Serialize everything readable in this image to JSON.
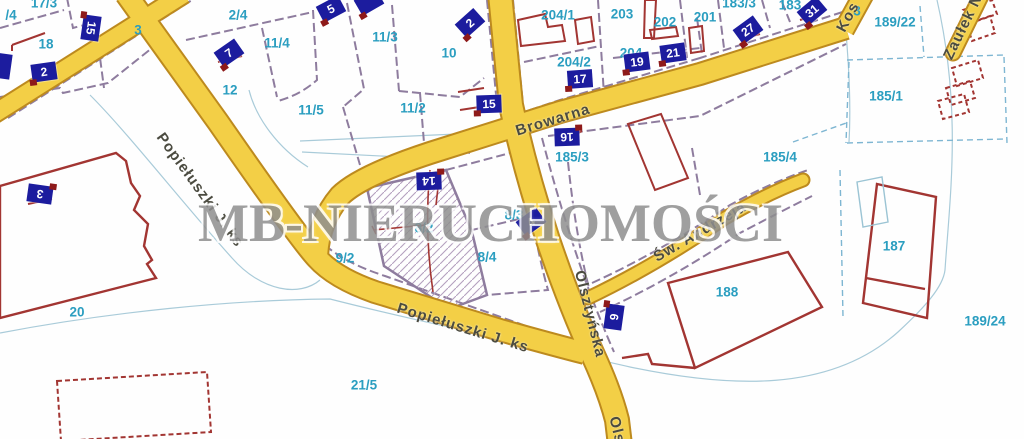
{
  "map": {
    "kind": "cadastral-map",
    "watermark": "MB-NIERUCHOMOŚCI",
    "highlighted_parcel": {
      "parcel": "8/2",
      "style": "diagonal-hatch"
    }
  },
  "colors": {
    "road_fill": "#F3CF46",
    "road_casing": "#BD8A1E",
    "parcel_line": "#8E7C9E",
    "building_line": "#A23532",
    "contour_line": "#A9CBD9",
    "parcel_dashed_blue": "#7EB6D2",
    "parcel_number_text": "#2B9EC0",
    "badge_background": "#1C1C9E",
    "badge_text": "#FFFFFF",
    "badge_notch": "#8E1A1A",
    "street_text": "#4B4B40",
    "watermark_text": "#8F8F8F"
  },
  "streets": [
    {
      "name": "Browarna",
      "x": 553,
      "y": 120,
      "rot": -17
    },
    {
      "name": "Popiełuszki J. ks",
      "x": 200,
      "y": 190,
      "rot": 54
    },
    {
      "name": "Popiełuszki J. ks",
      "x": 463,
      "y": 328,
      "rot": 17
    },
    {
      "name": "Olsztyńska",
      "x": 590,
      "y": 314,
      "rot": 76
    },
    {
      "name": "Olsz",
      "x": 618,
      "y": 434,
      "rot": 76
    },
    {
      "name": "Św. Andrzeja",
      "x": 700,
      "y": 232,
      "rot": -30
    },
    {
      "name": "Kos",
      "x": 848,
      "y": 17,
      "rot": -62
    },
    {
      "name": "Zaułek N",
      "x": 963,
      "y": 27,
      "rot": -64
    }
  ],
  "parcel_labels": [
    {
      "text": "17/3",
      "x": 44,
      "y": 3
    },
    {
      "text": "/4",
      "x": 11,
      "y": 15
    },
    {
      "text": "18",
      "x": 46,
      "y": 44
    },
    {
      "text": "2/4",
      "x": 238,
      "y": 15
    },
    {
      "text": "3",
      "x": 138,
      "y": 30
    },
    {
      "text": "11/4",
      "x": 277,
      "y": 43
    },
    {
      "text": "11/3",
      "x": 385,
      "y": 37
    },
    {
      "text": "10",
      "x": 449,
      "y": 53
    },
    {
      "text": "12",
      "x": 230,
      "y": 90
    },
    {
      "text": "11/5",
      "x": 311,
      "y": 110
    },
    {
      "text": "11/2",
      "x": 413,
      "y": 108
    },
    {
      "text": "204/1",
      "x": 558,
      "y": 15
    },
    {
      "text": "203",
      "x": 622,
      "y": 14
    },
    {
      "text": "202",
      "x": 665,
      "y": 22
    },
    {
      "text": "201",
      "x": 705,
      "y": 17
    },
    {
      "text": "183/3",
      "x": 739,
      "y": 3
    },
    {
      "text": "183",
      "x": 790,
      "y": 5
    },
    {
      "text": "204/2",
      "x": 574,
      "y": 62
    },
    {
      "text": "204",
      "x": 631,
      "y": 53
    },
    {
      "text": "189/22",
      "x": 895,
      "y": 22
    },
    {
      "text": "3",
      "x": 857,
      "y": 11
    },
    {
      "text": "185/1",
      "x": 886,
      "y": 96
    },
    {
      "text": "185/3",
      "x": 572,
      "y": 157
    },
    {
      "text": "185/4",
      "x": 780,
      "y": 157
    },
    {
      "text": "9/2",
      "x": 345,
      "y": 258
    },
    {
      "text": "8/2",
      "x": 424,
      "y": 228
    },
    {
      "text": "8/4",
      "x": 487,
      "y": 257
    },
    {
      "text": "8/3",
      "x": 514,
      "y": 215
    },
    {
      "text": "187",
      "x": 894,
      "y": 246
    },
    {
      "text": "188",
      "x": 727,
      "y": 292
    },
    {
      "text": "189/24",
      "x": 985,
      "y": 321
    },
    {
      "text": "20",
      "x": 77,
      "y": 312
    },
    {
      "text": "21/5",
      "x": 364,
      "y": 385
    }
  ],
  "house_number_badges": [
    {
      "number": "2",
      "x": 44,
      "y": 72,
      "rot": -8
    },
    {
      "number": "15",
      "x": 91,
      "y": 28,
      "rot": 98
    },
    {
      "number": "7",
      "x": 229,
      "y": 53,
      "rot": -35
    },
    {
      "number": "5",
      "x": 331,
      "y": 9,
      "rot": -28
    },
    {
      "number": "",
      "x": 369,
      "y": 2,
      "rot": -30
    },
    {
      "number": "2",
      "x": 470,
      "y": 23,
      "rot": -42
    },
    {
      "number": "15",
      "x": 489,
      "y": 104,
      "rot": -2
    },
    {
      "number": "17",
      "x": 580,
      "y": 79,
      "rot": -4
    },
    {
      "number": "19",
      "x": 637,
      "y": 62,
      "rot": -7
    },
    {
      "number": "21",
      "x": 673,
      "y": 53,
      "rot": -8
    },
    {
      "number": "27",
      "x": 748,
      "y": 30,
      "rot": -36
    },
    {
      "number": "31",
      "x": 812,
      "y": 11,
      "rot": -40
    },
    {
      "number": "16",
      "x": 567,
      "y": 137,
      "rot": 178
    },
    {
      "number": "14",
      "x": 429,
      "y": 181,
      "rot": 178
    },
    {
      "number": "4",
      "x": 531,
      "y": 222,
      "rot": -36
    },
    {
      "number": "6",
      "x": 614,
      "y": 317,
      "rot": 98
    },
    {
      "number": "3",
      "x": 40,
      "y": 194,
      "rot": 188
    },
    {
      "number": "",
      "x": 2,
      "y": 66,
      "rot": 98
    }
  ]
}
